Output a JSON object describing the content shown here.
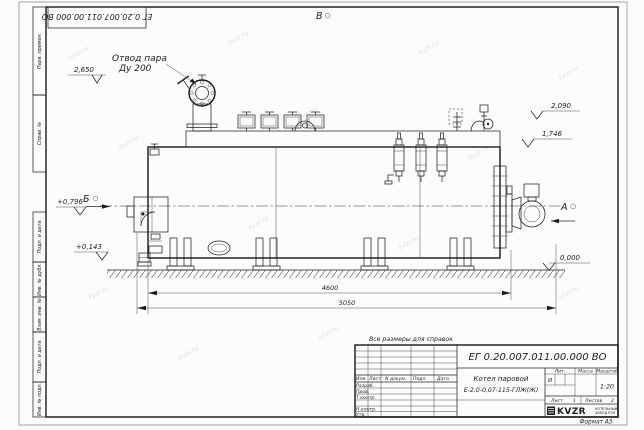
{
  "watermark": {
    "text": "kvzr.ru"
  },
  "frame": {
    "corner_stamp": "ЕГ 0.20.007.011.00.000  ВО",
    "format_label": "Формат А3",
    "side_labels": [
      "Перв. примен.",
      "Справ. №",
      "Подп. и дата",
      "Инв. № дубл.",
      "Взам. инв. №",
      "Подп. и дата",
      "Инв. № подл."
    ]
  },
  "drawing": {
    "note": "Все размеры для справок",
    "callout": {
      "line1": "Отвод пара",
      "line2": "Ду 200"
    },
    "views": {
      "a": "А",
      "b": "Б",
      "v": "В"
    },
    "elevations": {
      "valve_top": "2,650",
      "right_upper": "2,090",
      "right_lower": "1,746",
      "left_upper": "+0,796",
      "left_lower": "+0,143",
      "ground": "0,000"
    },
    "dimensions": {
      "boiler_length": "4600",
      "overall_length": "5050"
    }
  },
  "title_block": {
    "doc_number": "ЕГ 0.20.007.011.00.000  ВО",
    "product_line1": "Котел паровой",
    "product_line2": "Е-2,0-0,07-115-ГЛЖ(Ж)",
    "columns": {
      "izm": "Изм.",
      "list": "Лист",
      "ndokum": "N докум.",
      "podp": "Подп.",
      "data": "Дата"
    },
    "rows": {
      "razrab": "Разраб.",
      "prov": "Пров.",
      "tkontr": "Т.контр.",
      "nkontr": "Н.контр.",
      "utv": "Утв."
    },
    "lit": {
      "header": "Лит.",
      "value": "И"
    },
    "mass": {
      "header": "Масса"
    },
    "scale": {
      "header": "Масштаб",
      "value": "1:20"
    },
    "sheet": {
      "label": "Лист",
      "value": "1"
    },
    "sheets": {
      "label": "Листов",
      "value": "2"
    },
    "company": {
      "logo": "KVZR",
      "tagline1": "КОТЕЛЬНЫЙ",
      "tagline2": "ЗАВОД РЭП"
    }
  }
}
